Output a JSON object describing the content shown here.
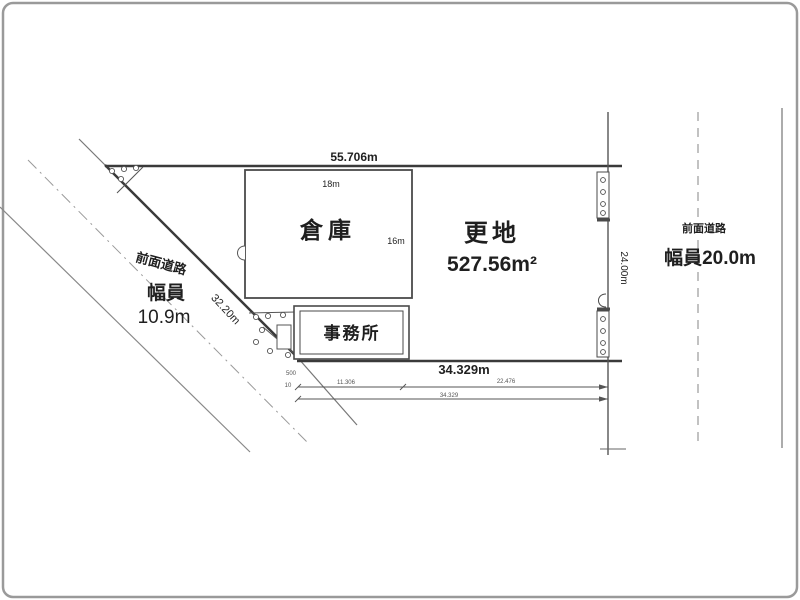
{
  "plan": {
    "title": "land-site-plan",
    "top_dimension": "55.706m",
    "bottom_dimension": "34.329m",
    "diagonal_dimension": "32.20m",
    "right_dimension": "24.00m",
    "warehouse": {
      "label": "倉庫",
      "width": "18m",
      "depth": "16m"
    },
    "office": {
      "label": "事務所"
    },
    "vacant_land": {
      "label": "更地",
      "area": "527.56m²"
    },
    "road_left": {
      "name": "前面道路",
      "width_label": "幅員",
      "width_value": "10.9m"
    },
    "road_right": {
      "name": "前面道路",
      "width_value": "幅員20.0m"
    },
    "sub_dimensions": {
      "tick_a": "500",
      "tick_b": "10",
      "segment1": "11.306",
      "segment2": "22.476",
      "total": "34.329"
    }
  },
  "colors": {
    "boundary": "#3a3a3a",
    "building": "#4a4a4a",
    "road_line": "#888888",
    "center_line": "#9a9a9a",
    "text": "#1f1f1f",
    "frame": "#9a9a9a"
  }
}
